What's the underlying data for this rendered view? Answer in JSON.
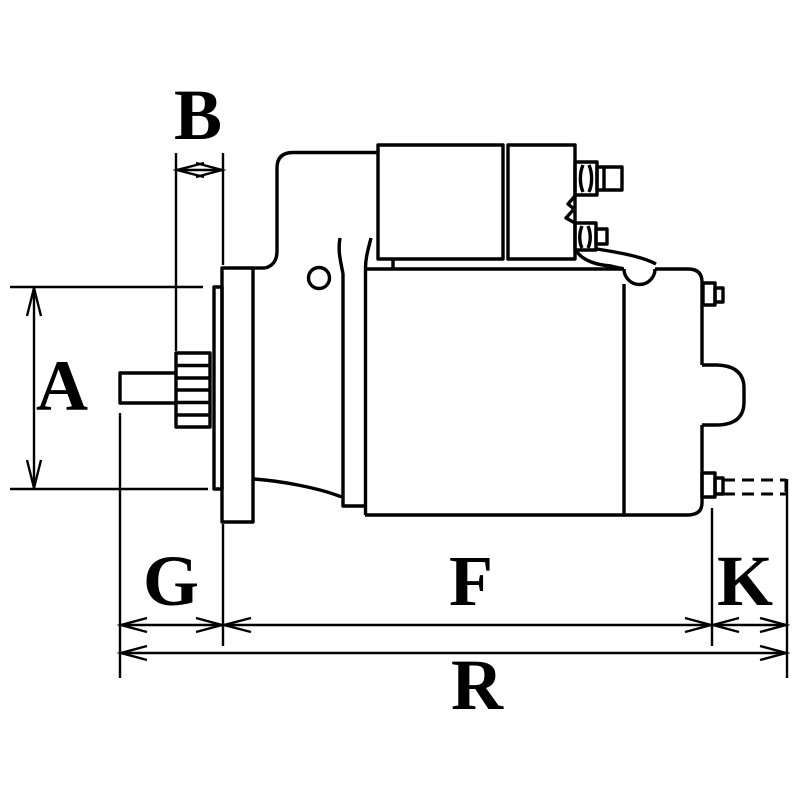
{
  "diagram": {
    "type": "technical-line-drawing",
    "subject": "starter motor side view with dimension callouts",
    "background_color": "#ffffff",
    "line_color": "#000000",
    "labels": {
      "A": "A",
      "B": "B",
      "G": "G",
      "F": "F",
      "K": "K",
      "R": "R"
    }
  }
}
